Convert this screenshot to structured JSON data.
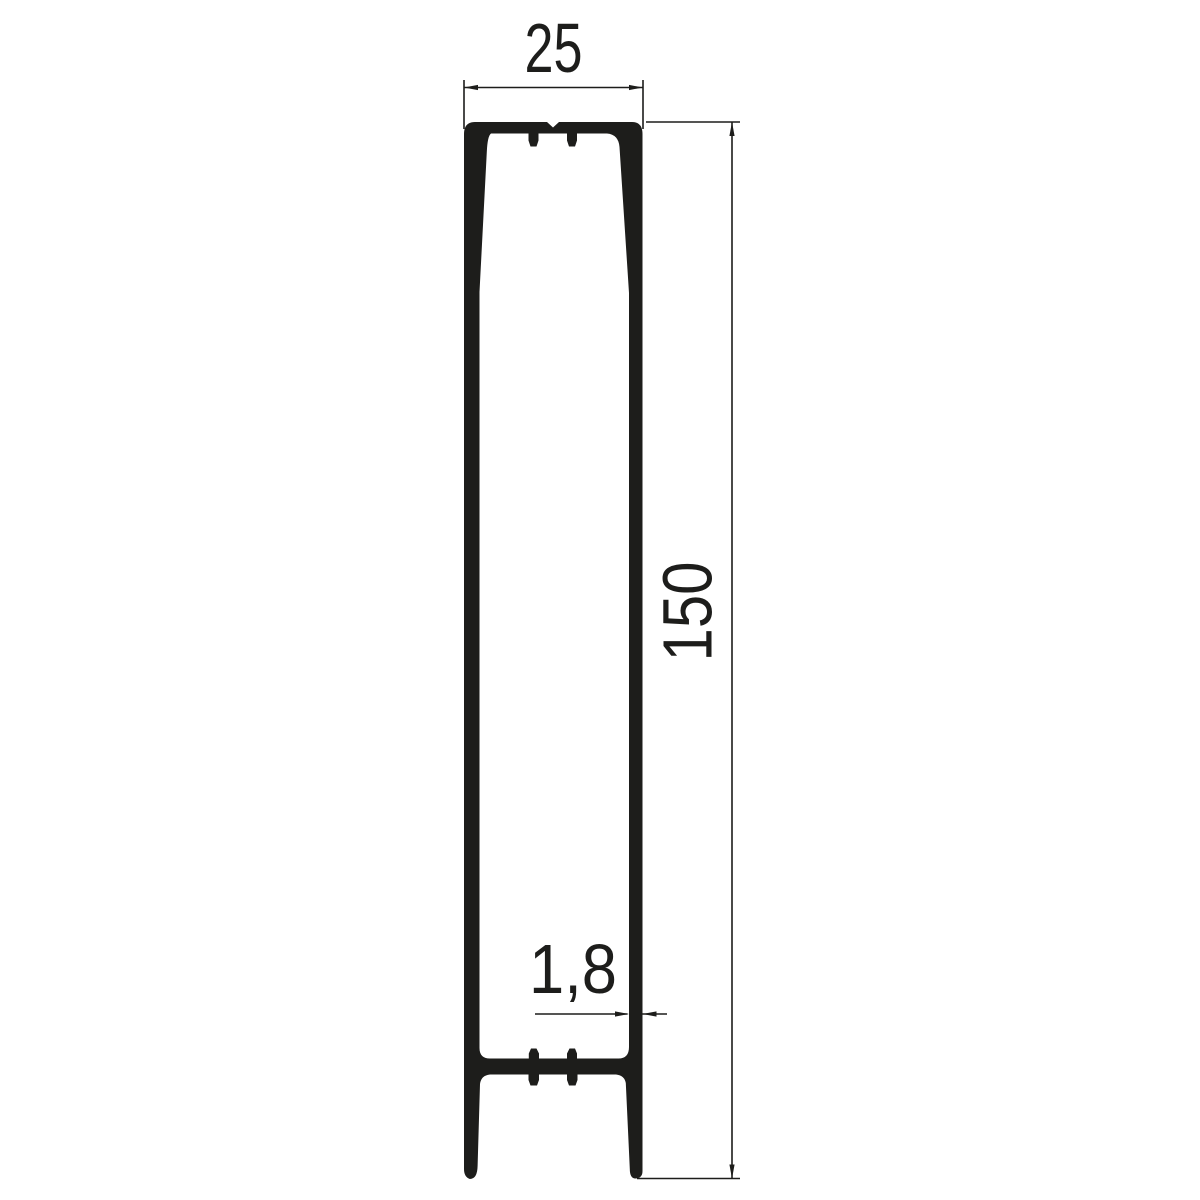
{
  "drawing": {
    "kind": "profile-cross-section",
    "dimensions": {
      "width": {
        "value": "25"
      },
      "height": {
        "value": "150"
      },
      "thickness": {
        "value": "1,8"
      }
    },
    "colors": {
      "ink": "#1d1d1b",
      "background": "#ffffff"
    }
  }
}
